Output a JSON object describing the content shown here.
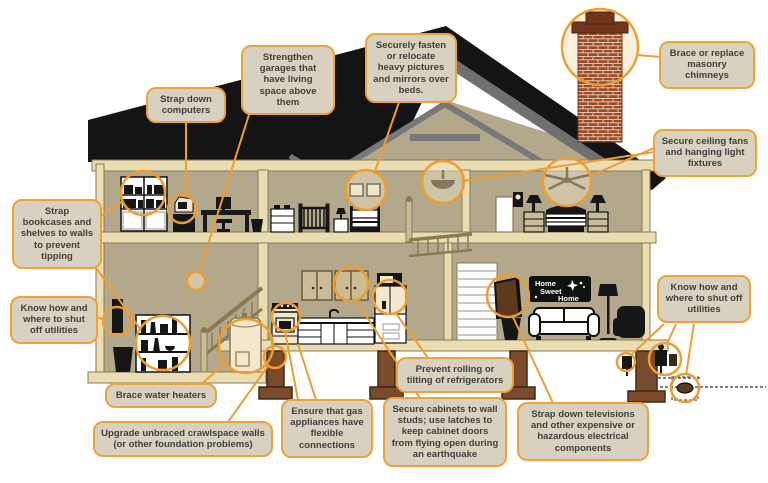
{
  "diagram": {
    "description": "Cross-section illustration of a house showing earthquake hazard mitigation tips",
    "accent_color": "#EE9D33",
    "callout_bg_color": "#D8D1BF",
    "callout_text_color": "#3F3F3F",
    "wall_color": "#B3A88C",
    "frame_color": "#EADDB4",
    "roof_color": "#141414",
    "brick_color": "#9B4B28",
    "pier_color": "#7A4A2B"
  },
  "sign": {
    "line1": "Home",
    "line2": "Sweet",
    "line3": "Home"
  },
  "callouts": [
    {
      "id": "strap-bookcases",
      "text": "Strap bookcases and shelves to walls to prevent tipping"
    },
    {
      "id": "know-utilities-left",
      "text": "Know how and where to shut off utilities"
    },
    {
      "id": "strap-computers",
      "text": "Strap down computers"
    },
    {
      "id": "strengthen-garages",
      "text": "Strengthen garages that have living space above them"
    },
    {
      "id": "fasten-pictures",
      "text": "Securely fasten or relocate heavy pictures and mirrors over beds."
    },
    {
      "id": "brace-chimneys",
      "text": "Brace or replace masonry chimneys"
    },
    {
      "id": "secure-ceiling-fans",
      "text": "Secure ceiling fans and hanging light fixtures"
    },
    {
      "id": "brace-water-heaters",
      "text": "Brace water heaters"
    },
    {
      "id": "upgrade-crawlspace",
      "text": "Upgrade unbraced crawlspace walls (or other foundation problems)"
    },
    {
      "id": "gas-flexible",
      "text": "Ensure that gas appliances have flexible connections"
    },
    {
      "id": "secure-cabinets",
      "text": "Secure cabinets to wall studs; use latches to keep cabinet doors from flying open during an earthquake"
    },
    {
      "id": "prevent-refrigerators",
      "text": "Prevent rolling or tilting of refrigerators"
    },
    {
      "id": "strap-televisions",
      "text": "Strap down televisions and other expensive or hazardous electrical components"
    },
    {
      "id": "know-utilities-right",
      "text": "Know how and where to shut off utilities"
    }
  ]
}
